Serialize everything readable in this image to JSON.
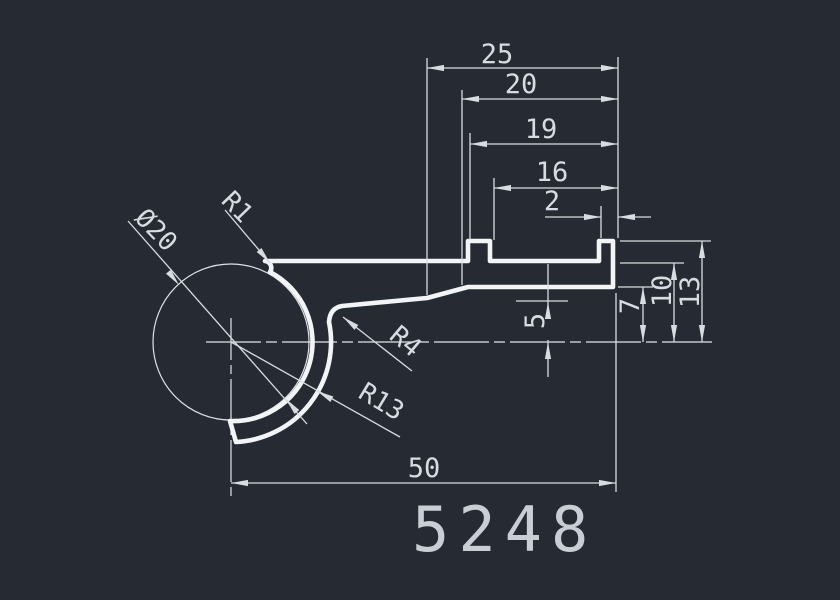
{
  "drawing": {
    "title": "profile-cross-section-drawing",
    "part_number": "5248",
    "theme": {
      "background": "#262b33",
      "profile_line_color": "#f2f4f6",
      "dimension_line_color": "#d8dce0",
      "centerline_color": "#dfe3e7"
    },
    "dimensions": {
      "top_chain": {
        "d25": "25",
        "d20": "20",
        "d19": "19",
        "d16": "16",
        "d2": "2"
      },
      "right_chain": {
        "d7": "7",
        "d10": "10",
        "d13": "13"
      },
      "middle": {
        "d5": "5"
      },
      "bottom": {
        "d50": "50"
      },
      "diameter": {
        "dia20": "Ø20"
      },
      "radii": {
        "r1": "R1",
        "r4": "R4",
        "r13": "R13"
      }
    }
  }
}
